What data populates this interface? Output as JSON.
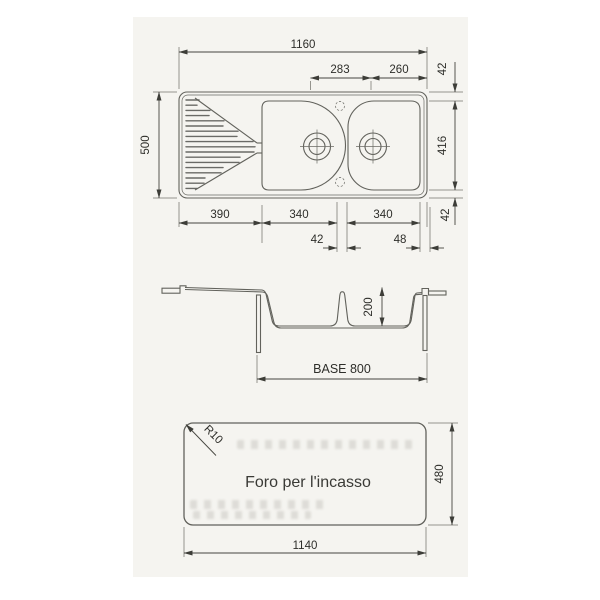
{
  "drawing_title": "sink-technical-drawing",
  "top_view": {
    "overall_width": "1160",
    "tap_span_left": "283",
    "tap_span_right": "260",
    "right_margin_top": "42",
    "bowl_height": "416",
    "right_margin_bottom": "42",
    "overall_height": "500",
    "drainer_width": "390",
    "bowl1_width": "340",
    "bowl2_width": "340",
    "divider_gap": "42",
    "right_gap": "48"
  },
  "section_view": {
    "bowl_depth": "200",
    "base_label": "BASE 800"
  },
  "cutout_view": {
    "corner_radius": "R10",
    "caption": "Foro per l'incasso",
    "cutout_height": "480",
    "cutout_width": "1140"
  }
}
